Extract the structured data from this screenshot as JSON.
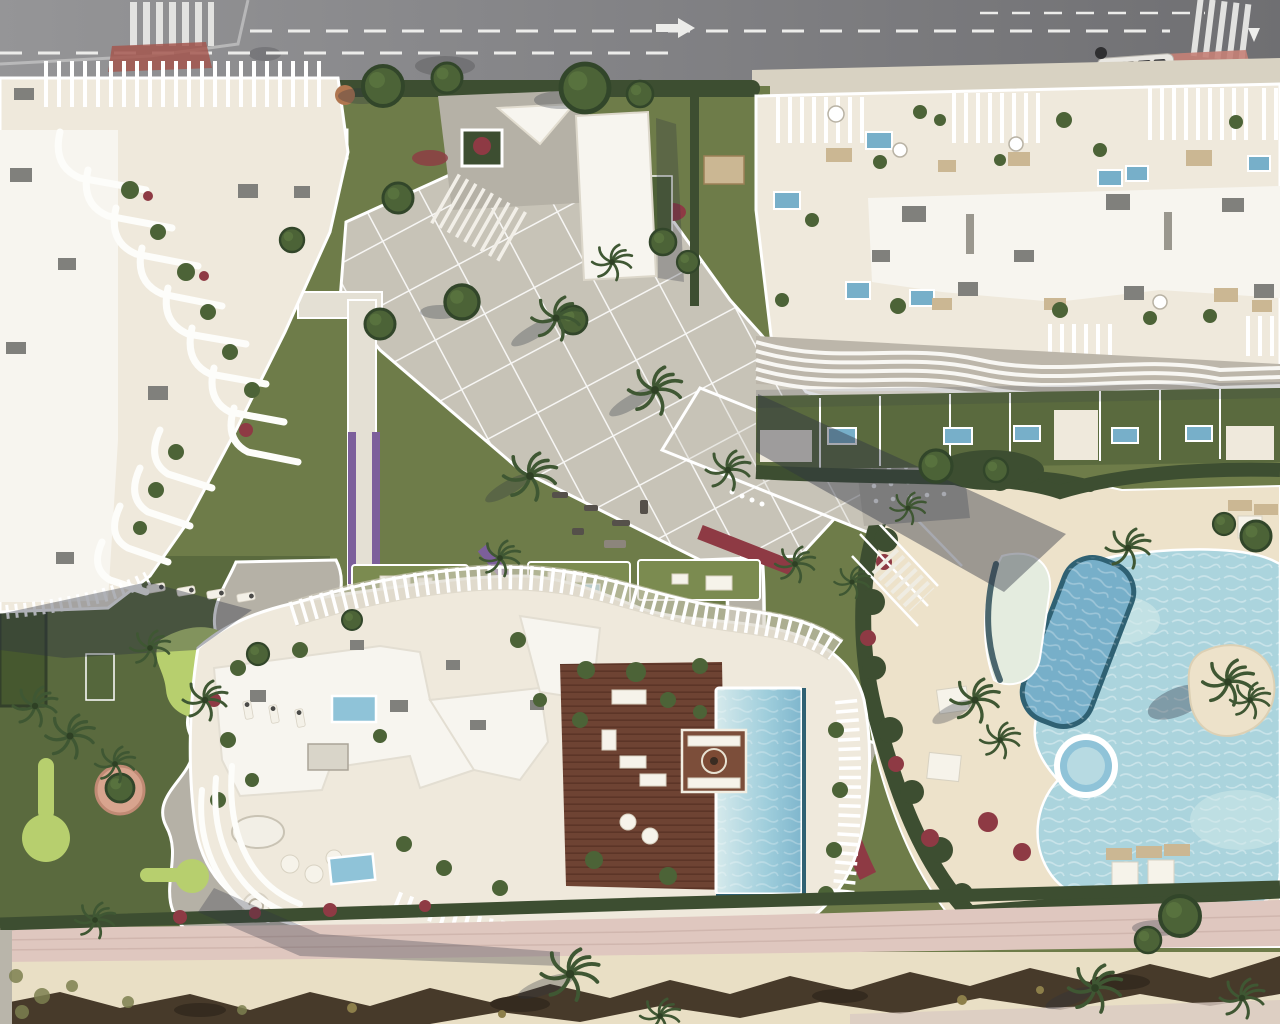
{
  "meta": {
    "description": "Top-down aerial 3D architectural rendering of a beachfront residential development: three sculptural white apartment buildings with rib-like balconies and rooftop terraces, landscaped gardens with paved plaza, mini-golf park, lagoon-style pools with palm island, and a sandy beach promenade along the bottom",
    "view": "top-down aerial",
    "style": "photorealistic render",
    "no_text_visible": true
  },
  "elements": {
    "road": "asphalt road with dashed lane markings and two zebra crosswalks",
    "bus": "white bus on road at top right",
    "building_left": "sculptural white building with diagonal cascade of curved ribs",
    "building_top_right": "large white building with rooftop terraces, pergolas and plunge pools",
    "building_bottom": "white building with rooftop wooden deck, fire pit lounge and infinity pool",
    "entrance_pavilion": "tall white entrance slab with triangular canopy and stairs",
    "plaza": "diagonal paved plaza with white joint grid",
    "mini_golf": "mini golf park with putting greens and winding path",
    "lagoon_pool": "free-form lagoon pool with palm island",
    "lap_pool": "angled lap pool with dark rim",
    "shallow_pool": "crescent beach-entry shallow pool",
    "jacuzzi": "round jacuzzi",
    "promenade": "pink paved promenade, sand and dark dune scrub strip"
  },
  "colors": {
    "road": "#8c8c8e",
    "roadDark": "#717174",
    "laneMark": "#ececea",
    "sidewalk": "#d8d2c2",
    "redPaving": "#a3574f",
    "pinkPaving": "#c58177",
    "grass": "#6e7c49",
    "lawnBright": "#7b8b50",
    "lawnDark": "#5a6a3e",
    "golfGreen": "#b7cf6e",
    "hedge": "#3d4e31",
    "tree": "#4c6337",
    "palm": "#3f5733",
    "purpleFlower": "#7c5f9b",
    "redFlower": "#8e3a44",
    "plazaPaver": "#c7c3b7",
    "pathGray": "#b5b1a6",
    "terrace": "#efe9dc",
    "roofWhite": "#f7f5ef",
    "acGray": "#80807c",
    "woodDeck": "#6e4333",
    "woodDark": "#5c3527",
    "woodLight": "#7c4e3a",
    "poolLight": "#c5e2e8",
    "poolMid": "#8fc3d8",
    "poolDark": "#77afc9",
    "poolRim": "#2f6173",
    "lagoon": "#abd4dd",
    "lagoonLight": "#d2e9ea",
    "sandDeck": "#ede2ca",
    "sandBeach": "#e9dfc5",
    "promenade": "#dfc7bf",
    "scrub": "#473a2a",
    "shadow": "#2d3242",
    "furnitureTan": "#cbb793",
    "umbrella": "#f6f3ea"
  }
}
